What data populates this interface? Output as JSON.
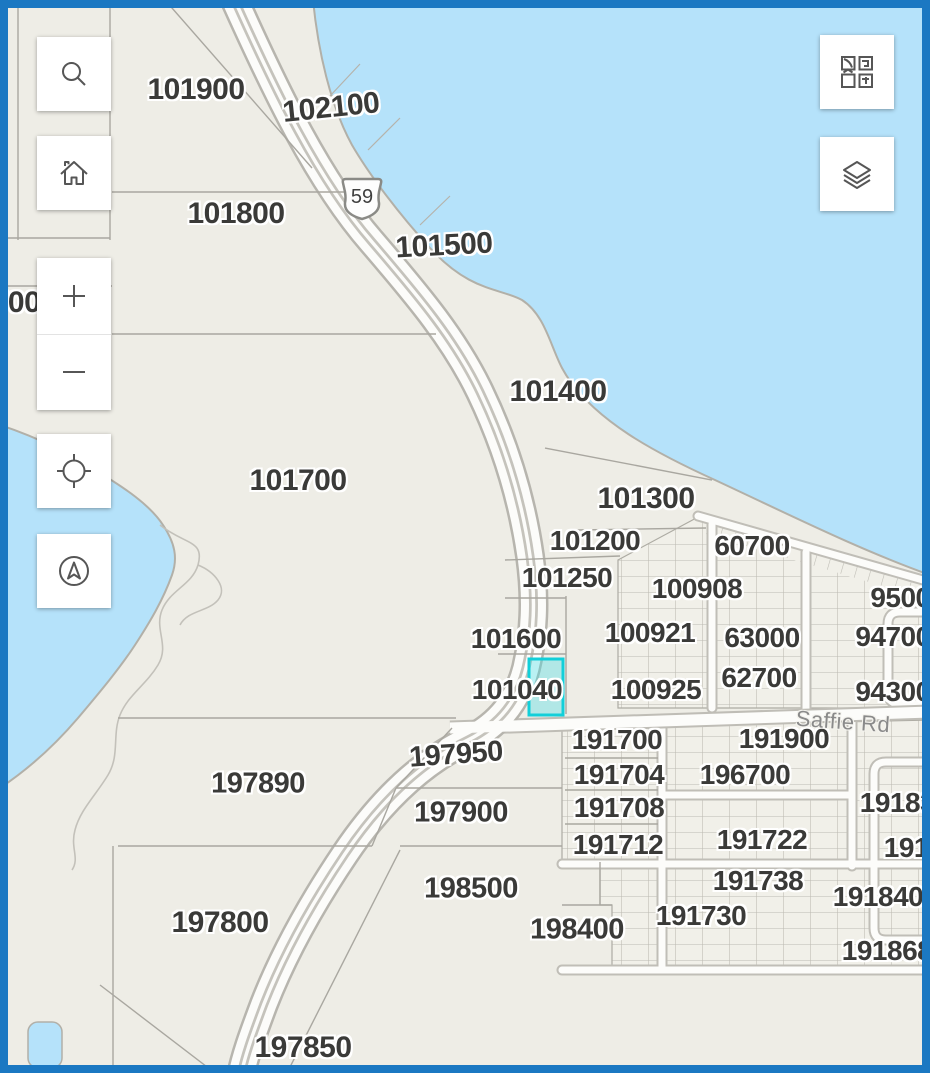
{
  "app": {
    "type": "parcel-map-viewer"
  },
  "colors": {
    "frame_border": "#1b78c2",
    "water": "#b5e2fa",
    "land": "#eeede6",
    "road_fill": "#fcfcfa",
    "road_casing": "#b7b5ae",
    "parcel_line": "#a9a7a0",
    "lot_grid_line": "#bcbab2",
    "label_color": "#3a3a38",
    "street_label_color": "#8a8a8a",
    "selection_outline": "#12cfd9",
    "icon_color": "#565656"
  },
  "map": {
    "route_shield": {
      "number": "59"
    },
    "selected_parcel": {
      "parcel_label": "101040",
      "x": 529,
      "y": 659,
      "width": 34,
      "height": 56,
      "outline_color": "#12cfd9",
      "fill_color": "rgba(64,220,228,0.35)"
    },
    "labels": {
      "parcel": [
        {
          "t": "101900",
          "x": 196,
          "y": 90,
          "s": 30
        },
        {
          "t": "102100",
          "x": 331,
          "y": 108,
          "s": 30,
          "r": -6
        },
        {
          "t": "101800",
          "x": 236,
          "y": 214,
          "s": 30
        },
        {
          "t": "101500",
          "x": 444,
          "y": 246,
          "s": 30,
          "r": -3
        },
        {
          "t": "101400",
          "x": 558,
          "y": 392,
          "s": 30
        },
        {
          "t": "700",
          "x": 16,
          "y": 303,
          "s": 30,
          "n": "partial-parcel-label"
        },
        {
          "t": "101700",
          "x": 298,
          "y": 481,
          "s": 30
        },
        {
          "t": "101300",
          "x": 646,
          "y": 499,
          "s": 30
        },
        {
          "t": "101200",
          "x": 595,
          "y": 541,
          "s": 28
        },
        {
          "t": "60700",
          "x": 752,
          "y": 546,
          "s": 28
        },
        {
          "t": "101250",
          "x": 567,
          "y": 578,
          "s": 28
        },
        {
          "t": "100908",
          "x": 697,
          "y": 589,
          "s": 28
        },
        {
          "t": "95000",
          "x": 908,
          "y": 598,
          "s": 28,
          "n": "partial-parcel-label"
        },
        {
          "t": "100921",
          "x": 650,
          "y": 633,
          "s": 28
        },
        {
          "t": "63000",
          "x": 762,
          "y": 638,
          "s": 28
        },
        {
          "t": "94700",
          "x": 893,
          "y": 637,
          "s": 28
        },
        {
          "t": "101600",
          "x": 516,
          "y": 639,
          "s": 28
        },
        {
          "t": "62700",
          "x": 759,
          "y": 678,
          "s": 28
        },
        {
          "t": "101040",
          "x": 517,
          "y": 690,
          "s": 28
        },
        {
          "t": "100925",
          "x": 656,
          "y": 690,
          "s": 28
        },
        {
          "t": "94300",
          "x": 893,
          "y": 692,
          "s": 28
        },
        {
          "t": "191700",
          "x": 617,
          "y": 740,
          "s": 28
        },
        {
          "t": "191900",
          "x": 784,
          "y": 739,
          "s": 28
        },
        {
          "t": "197950",
          "x": 456,
          "y": 755,
          "s": 29,
          "r": -4
        },
        {
          "t": "191704",
          "x": 619,
          "y": 775,
          "s": 28
        },
        {
          "t": "196700",
          "x": 745,
          "y": 775,
          "s": 28
        },
        {
          "t": "197890",
          "x": 258,
          "y": 784,
          "s": 29
        },
        {
          "t": "191708",
          "x": 619,
          "y": 808,
          "s": 28
        },
        {
          "t": "191832",
          "x": 905,
          "y": 803,
          "s": 28,
          "n": "partial-parcel-label"
        },
        {
          "t": "197900",
          "x": 461,
          "y": 813,
          "s": 29
        },
        {
          "t": "191712",
          "x": 618,
          "y": 845,
          "s": 28
        },
        {
          "t": "191850",
          "x": 929,
          "y": 848,
          "s": 28,
          "n": "partial-parcel-label"
        },
        {
          "t": "191722",
          "x": 762,
          "y": 840,
          "s": 28
        },
        {
          "t": "191738",
          "x": 758,
          "y": 881,
          "s": 28
        },
        {
          "t": "198500",
          "x": 471,
          "y": 889,
          "s": 29
        },
        {
          "t": "191840",
          "x": 878,
          "y": 897,
          "s": 28
        },
        {
          "t": "191730",
          "x": 701,
          "y": 916,
          "s": 28
        },
        {
          "t": "198400",
          "x": 577,
          "y": 930,
          "s": 29
        },
        {
          "t": "191868",
          "x": 887,
          "y": 951,
          "s": 28
        },
        {
          "t": "197800",
          "x": 220,
          "y": 923,
          "s": 30
        },
        {
          "t": "197850",
          "x": 303,
          "y": 1048,
          "s": 30
        },
        {
          "t": "197810",
          "x": 152,
          "y": 1081,
          "s": 30,
          "n": "partial-parcel-label"
        },
        {
          "t": "197880",
          "x": 452,
          "y": 1082,
          "s": 30,
          "n": "partial-parcel-label"
        }
      ],
      "street": [
        {
          "t": "Saffie Rd",
          "x": 843,
          "y": 722,
          "s": 22,
          "r": 4
        }
      ]
    }
  },
  "controls": {
    "left": [
      {
        "name": "search-button",
        "icon": "search-icon"
      },
      {
        "name": "home-button",
        "icon": "home-icon"
      },
      {
        "name": "zoom-in-button",
        "icon": "plus-icon"
      },
      {
        "name": "zoom-out-button",
        "icon": "minus-icon"
      },
      {
        "name": "locate-button",
        "icon": "locate-icon"
      },
      {
        "name": "compass-button",
        "icon": "compass-icon"
      }
    ],
    "right": [
      {
        "name": "basemap-gallery-button",
        "icon": "basemap-grid-icon"
      },
      {
        "name": "layers-button",
        "icon": "layers-icon"
      }
    ]
  }
}
